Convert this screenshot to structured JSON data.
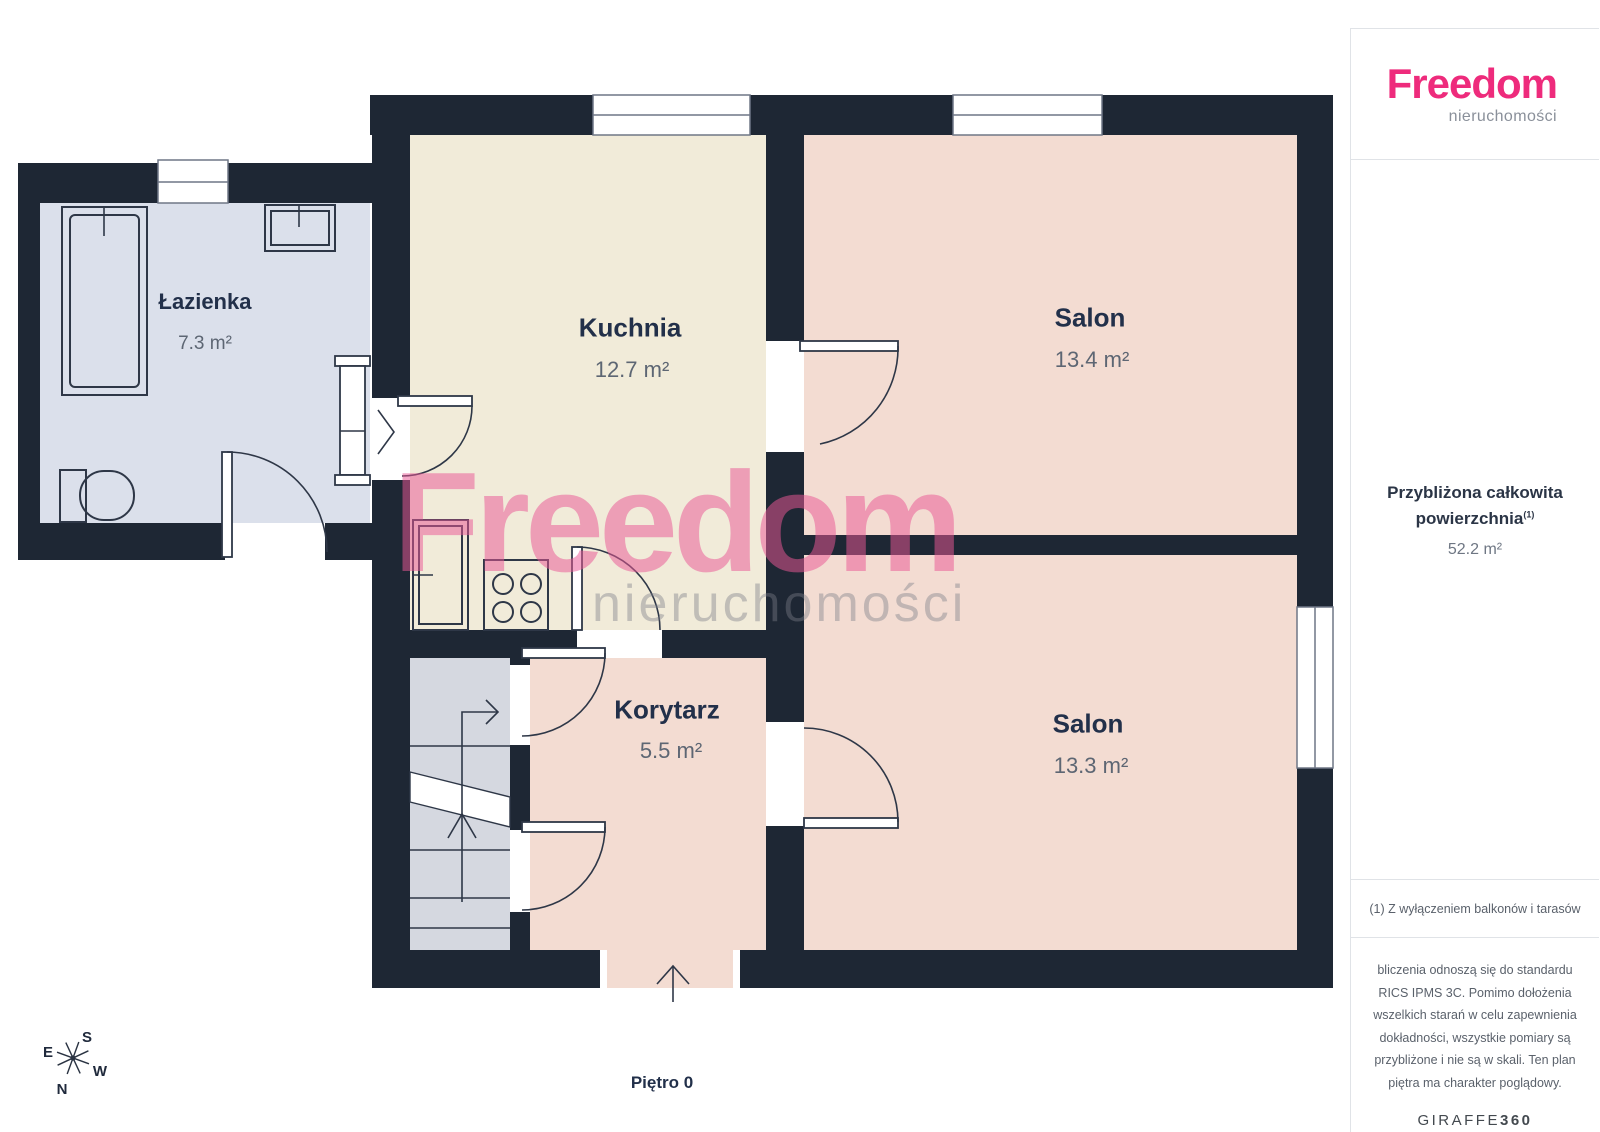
{
  "page": {
    "floor_label": "Piętro 0"
  },
  "watermark": {
    "line1": "Freedom",
    "line2": "nieruchomości"
  },
  "rooms": [
    {
      "name": "Łazienka",
      "area": "7.3 m²"
    },
    {
      "name": "Kuchnia",
      "area": "12.7 m²"
    },
    {
      "name": "Salon",
      "area": "13.4 m²"
    },
    {
      "name": "Korytarz",
      "area": "5.5 m²"
    },
    {
      "name": "Salon",
      "area": "13.3 m²"
    }
  ],
  "compass": {
    "n": "N",
    "s": "S",
    "e": "E",
    "w": "W"
  },
  "sidebar": {
    "logo_title": "Freedom",
    "logo_subtitle": "nieruchomości",
    "area_label_line1": "Przybliżona całkowita",
    "area_label_line2": "powierzchnia",
    "area_footnote_ref": "(1)",
    "area_value": "52.2 m²",
    "footnote": "(1) Z wyłączeniem balkonów i tarasów",
    "disclaimer": "bliczenia odnoszą się do standardu RICS IPMS 3C. Pomimo dołożenia wszelkich starań w celu zapewnienia dokładności, wszystkie pomiary są przybliżone i nie są w skali. Ten plan piętra ma charakter poglądowy.",
    "brand_regular": "GIRAFFE",
    "brand_bold": "360"
  },
  "colors": {
    "wall": "#1e2734",
    "bathroom": "#dbe0eb",
    "kitchen": "#f1ebd9",
    "living": "#f3dcd2",
    "stairs": "#d5d8e0",
    "accent_pink": "#ee2b7c"
  }
}
